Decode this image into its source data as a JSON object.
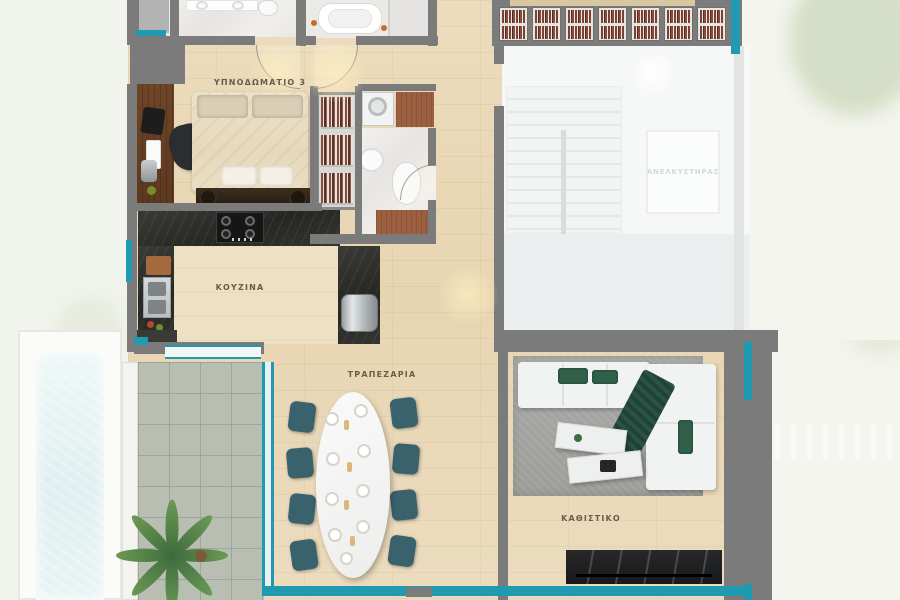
{
  "meta": {
    "title": "Apartment floor plan – level with bedroom 3, kitchen, dining and living room"
  },
  "colors": {
    "accent_teal": "#1f9ab1",
    "wall_gray": "#7b7b7b",
    "wood_floor": "#e9d8b8",
    "counter_dark": "#32322e",
    "terrace_tile": "#b9beb3",
    "pool_water": "#e7f3f4",
    "books_red": "#84453a",
    "sofa_green": "#2f5547",
    "chair_teal": "#3a626d",
    "exterior": "#f3f5ee"
  },
  "rooms": {
    "bedroom": {
      "label": "ΥΠΝΟΔΩΜΑΤΙΟ 3"
    },
    "kitchen": {
      "label": "ΚΟΥΖΙΝΑ"
    },
    "dining": {
      "label": "ΤΡΑΠΕΖΑΡΙΑ"
    },
    "living": {
      "label": "ΚΑΘΙΣΤΙΚΟ"
    },
    "elevator": {
      "label": "ΑΝΕΛΚΥΣΤΗΡΑΣ"
    }
  }
}
